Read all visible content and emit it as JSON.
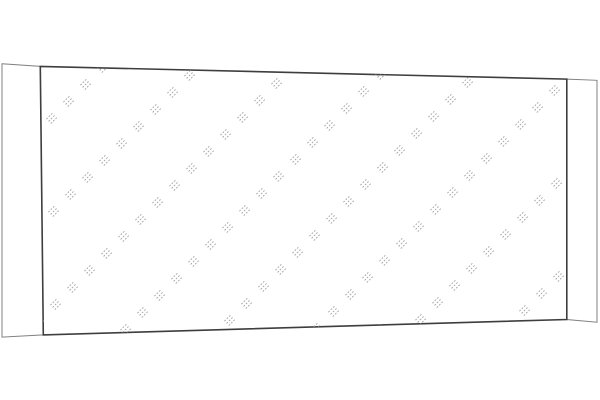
{
  "canvas": {
    "width": 600,
    "height": 400,
    "background": "#ffffff"
  },
  "mirror": {
    "description": "mirror glass panel line illustration in slight perspective",
    "left_strip": {
      "points": "2,63.8 40.3,66.4 43.3,334.9 2,337.1",
      "stroke": "#808080",
      "stroke_width": 1
    },
    "right_strip": {
      "points": "566.8,79.1 597,80.3 597,322.2 566.8,319.5",
      "stroke": "#808080",
      "stroke_width": 1
    },
    "glass": {
      "points": "40.3,66.4 566.8,79.1 566.8,319.5 43.3,334.9",
      "stroke": "#3e3e3e",
      "stroke_width": 1.6
    },
    "hatch": {
      "color": "#a2a2a2",
      "stroke_width": 0.9,
      "dash": "1.8 1.5",
      "chain_sum_start": 170,
      "chain_sum_end": 900,
      "chain_spacing": 95,
      "step_x": 17,
      "lines_per_group": 3,
      "line_length": 9.5,
      "line_gap": 3.1,
      "x_min": 35,
      "x_max": 575,
      "y_min": 55,
      "y_max": 345
    }
  }
}
